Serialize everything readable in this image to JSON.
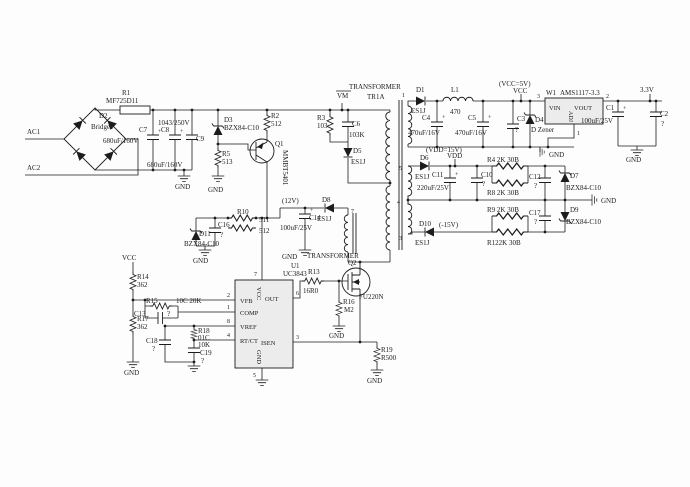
{
  "sym": {
    "gnd": "GND",
    "plus": "+"
  },
  "input": {
    "ac1": "AC1",
    "ac2": "AC2",
    "d2_ref": "D2",
    "d2_val": "Bridge1",
    "r1_ref": "R1",
    "r1_val": "MF725D11",
    "c7_ref": "C7",
    "c7_val": "680uF/160V",
    "c8_ref": "C8",
    "c8_val": "680uF/160V",
    "c9_ref": "C9",
    "c9_val": "1043/250V",
    "d3_ref": "D3",
    "d3_val": "BZX84-C10",
    "r5_ref": "R5",
    "r5_val": "513",
    "r2_ref": "R2",
    "r2_val": "512",
    "q1_ref": "Q1",
    "q1_val": "MMBT5401"
  },
  "snubber": {
    "vm": "VM",
    "r3_ref": "R3",
    "r3_val": "103",
    "c6_ref": "C6",
    "c6_val": "103K",
    "d5_ref": "D5",
    "d5_val": "ES1J"
  },
  "transformer": {
    "name": "TRANSFORMER",
    "ref": "TR1A",
    "pin1": "1",
    "pin5": "5",
    "pin4": "4",
    "pin3": "3",
    "pin7": "7",
    "name2": "TRANSFORMER"
  },
  "rail5v": {
    "d1_ref": "D1",
    "d1_val": "ES1J",
    "l1_ref": "L1",
    "l1_val": "470",
    "c4_ref": "C4",
    "c4_val": "470uF/16V",
    "c5_ref": "C5",
    "c5_val": "470uF/16V",
    "c3_ref": "C3",
    "c3_val": "?",
    "d4_ref": "D4",
    "d4_val": "D Zener",
    "vcc_note": "(VCC=5V)",
    "vcc": "VCC",
    "w1_ref": "W1",
    "w1_val": "AMS1117-3.3",
    "pin_vin": "VIN",
    "pin_vout": "VOUT",
    "pin_adj": "ADJ",
    "n3": "3",
    "n2": "2",
    "n1": "1",
    "v33": "3.3V",
    "c1_ref": "C1",
    "c1_val": "100uF/25V",
    "c2_ref": "C2",
    "c2_val": "?"
  },
  "rail15v": {
    "vdd_note": "(VDD=15V)",
    "vdd": "VDD",
    "d6_ref": "D6",
    "d6_val": "ES1J",
    "c11_ref": "C11",
    "c11_val": "220uF/25V",
    "c10_ref": "C10",
    "c10_val": "?",
    "r4": "R4 2K 30B",
    "r8": "R8 2K 30B",
    "c12_ref": "C12",
    "c12_val": "?",
    "d7_ref": "D7",
    "d7_val": "BZX84-C10",
    "r9": "R9 2K 30B",
    "r12": "R122K 30B",
    "c17_ref": "C17",
    "c17_val": "?",
    "d9_ref": "D9",
    "d9_val": "BZX84-C10",
    "d10_ref": "D10",
    "d10_val": "ES1J",
    "neg15": "(-15V)"
  },
  "aux12v": {
    "v12": "(12V)",
    "d8_ref": "D8",
    "d8_val": "ES1J",
    "c14_ref": "C14",
    "c14_val": "100uF/25V",
    "d11_ref": "D11",
    "d11_val": "BZX84-C10",
    "c16_ref": "C16",
    "c16_val": "?",
    "r10_ref": "R10",
    "r10_val": "511",
    "r11_val": "512"
  },
  "controller": {
    "vcc": "VCC",
    "r14_ref": "R14",
    "r14_val": "362",
    "r15_ref": "R15",
    "r15_val": "10C 20K",
    "c13_ref": "C13",
    "c13_val": "?",
    "r17_ref": "R17",
    "r17_val": "362",
    "r18_ref": "R18",
    "r18_val1": "01C",
    "r18_val2": "10K",
    "c18_ref": "C18",
    "c18_val": "?",
    "c19_ref": "C19",
    "c19_val": "?",
    "u1_ref": "U1",
    "u1_val": "UC3843",
    "pin_vfb": "VFB",
    "pin_comp": "COMP",
    "pin_vref": "VREF",
    "pin_rtct": "RT/CT",
    "pin_out": "OUT",
    "pin_isen": "ISEN",
    "pin_vcc": "VCC",
    "pin_gnd": "GND",
    "n1": "1",
    "n2": "2",
    "n3": "3",
    "n4": "4",
    "n5": "5",
    "n6": "6",
    "n7": "7",
    "n8": "8"
  },
  "power_stage": {
    "r13_ref": "R13",
    "r13_val": "16R0",
    "q2_ref": "Q2",
    "q2_val": "FU220N",
    "r16_ref": "R16",
    "r16_val": "M2",
    "r19_ref": "R19",
    "r19_val": "R500"
  }
}
